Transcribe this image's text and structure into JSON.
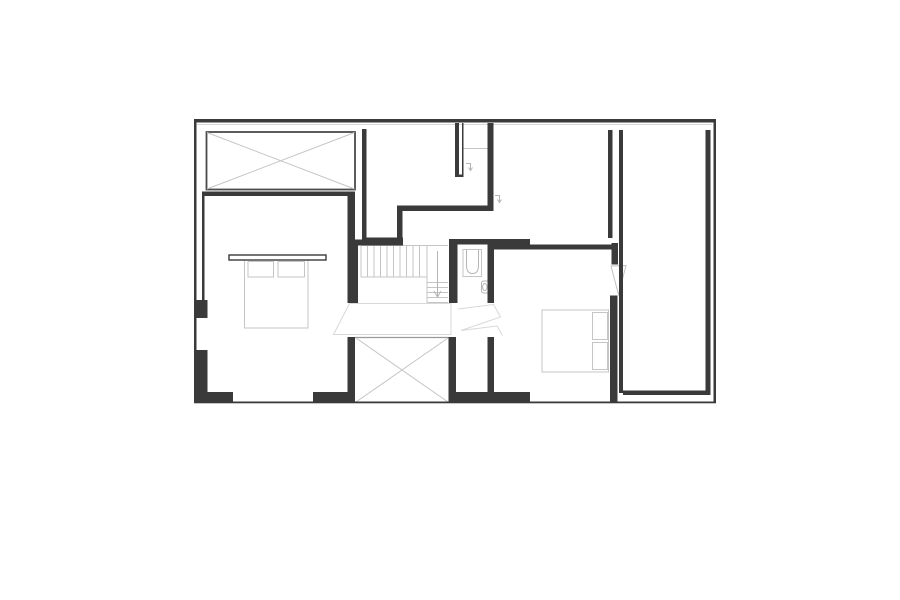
{
  "canvas": {
    "width": 900,
    "height": 600,
    "background": "#ffffff"
  },
  "palette": {
    "wall_color": "#3a3a3a",
    "outline_color": "#4a4a4a",
    "light_gray": "#c5c5c5",
    "mid_gray": "#9a9a9a",
    "fixture_gray": "#b5b5b5",
    "shadow_gray": "#d8d8d8"
  },
  "plan": {
    "styles": {
      "wall": {
        "fill": "#3a3a3a",
        "stroke": "none",
        "sw": 0
      },
      "outline": {
        "fill": "none",
        "stroke": "#4a4a4a",
        "sw": 1.8
      },
      "light": {
        "fill": "none",
        "stroke": "#c5c5c5",
        "sw": 1
      },
      "lighter": {
        "fill": "none",
        "stroke": "#d8d8d8",
        "sw": 1
      },
      "mid": {
        "fill": "none",
        "stroke": "#9a9a9a",
        "sw": 1.2
      },
      "fixture": {
        "fill": "none",
        "stroke": "#b5b5b5",
        "sw": 1
      },
      "headboard": {
        "fill": "#ffffff",
        "stroke": "#3a3a3a",
        "sw": 1.4
      },
      "leaf": {
        "fill": "#ffffff",
        "stroke": "#c0c0c0",
        "sw": 1
      }
    },
    "shapes": [
      {
        "name": "top-wall-shadow-line",
        "kind": "line",
        "x1": 197,
        "y1": 124.5,
        "x2": 712,
        "y2": 124.5,
        "style": "lighter"
      },
      {
        "name": "skylight-box-outline",
        "kind": "rect",
        "x": 206.5,
        "y": 132,
        "w": 148.5,
        "h": 57.5,
        "style": "outline"
      },
      {
        "name": "skylight-box-diagonal",
        "kind": "line",
        "x1": 207,
        "y1": 132.5,
        "x2": 354.5,
        "y2": 189,
        "style": "light"
      },
      {
        "name": "skylight-box-diagonal",
        "kind": "line",
        "x1": 354.5,
        "y1": 132.5,
        "x2": 207,
        "y2": 189,
        "style": "light"
      },
      {
        "name": "void-box-top-edge",
        "kind": "line",
        "x1": 355,
        "y1": 337.5,
        "x2": 448.5,
        "y2": 337.5,
        "style": "mid"
      },
      {
        "name": "void-box-diagonal",
        "kind": "line",
        "x1": 356,
        "y1": 338,
        "x2": 448,
        "y2": 402,
        "style": "light"
      },
      {
        "name": "void-box-diagonal",
        "kind": "line",
        "x1": 448,
        "y1": 338,
        "x2": 356,
        "y2": 402,
        "style": "light"
      },
      {
        "name": "stair-tread",
        "kind": "line",
        "x1": 361,
        "y1": 246,
        "x2": 361,
        "y2": 277,
        "style": "light"
      },
      {
        "name": "stair-tread",
        "kind": "line",
        "x1": 367.5,
        "y1": 246,
        "x2": 367.5,
        "y2": 277,
        "style": "light"
      },
      {
        "name": "stair-tread",
        "kind": "line",
        "x1": 374,
        "y1": 246,
        "x2": 374,
        "y2": 277,
        "style": "light"
      },
      {
        "name": "stair-tread",
        "kind": "line",
        "x1": 380.5,
        "y1": 246,
        "x2": 380.5,
        "y2": 277,
        "style": "light"
      },
      {
        "name": "stair-tread",
        "kind": "line",
        "x1": 387,
        "y1": 246,
        "x2": 387,
        "y2": 277,
        "style": "light"
      },
      {
        "name": "stair-tread",
        "kind": "line",
        "x1": 393.5,
        "y1": 246,
        "x2": 393.5,
        "y2": 277,
        "style": "light"
      },
      {
        "name": "stair-tread",
        "kind": "line",
        "x1": 400,
        "y1": 246,
        "x2": 400,
        "y2": 277,
        "style": "light"
      },
      {
        "name": "stair-tread",
        "kind": "line",
        "x1": 406.5,
        "y1": 246,
        "x2": 406.5,
        "y2": 277,
        "style": "light"
      },
      {
        "name": "stair-tread",
        "kind": "line",
        "x1": 413,
        "y1": 246,
        "x2": 413,
        "y2": 277,
        "style": "light"
      },
      {
        "name": "stair-tread",
        "kind": "line",
        "x1": 419.5,
        "y1": 246,
        "x2": 419.5,
        "y2": 277,
        "style": "light"
      },
      {
        "name": "stair-top-edge",
        "kind": "line",
        "x1": 361,
        "y1": 245.5,
        "x2": 448,
        "y2": 245.5,
        "style": "light"
      },
      {
        "name": "stair-flight-edge",
        "kind": "line",
        "x1": 427,
        "y1": 245.5,
        "x2": 427,
        "y2": 302.5,
        "style": "light"
      },
      {
        "name": "stair-landing-edge",
        "kind": "line",
        "x1": 361,
        "y1": 277,
        "x2": 427,
        "y2": 277,
        "style": "light"
      },
      {
        "name": "stair-tread",
        "kind": "line",
        "x1": 427,
        "y1": 282.5,
        "x2": 448,
        "y2": 282.5,
        "style": "light"
      },
      {
        "name": "stair-tread",
        "kind": "line",
        "x1": 427,
        "y1": 287.5,
        "x2": 448,
        "y2": 287.5,
        "style": "light"
      },
      {
        "name": "stair-tread",
        "kind": "line",
        "x1": 427,
        "y1": 292.5,
        "x2": 448,
        "y2": 292.5,
        "style": "light"
      },
      {
        "name": "stair-tread",
        "kind": "line",
        "x1": 427,
        "y1": 297.5,
        "x2": 448,
        "y2": 297.5,
        "style": "light"
      },
      {
        "name": "stair-bottom-edge",
        "kind": "line",
        "x1": 427,
        "y1": 302.5,
        "x2": 448,
        "y2": 302.5,
        "style": "light"
      },
      {
        "name": "stair-direction-arrow-stem",
        "kind": "line",
        "x1": 437.5,
        "y1": 251,
        "x2": 437.5,
        "y2": 296,
        "style": "fixture"
      },
      {
        "name": "stair-direction-arrow-head",
        "kind": "polyline",
        "points": "434,291 437.5,297 441,291",
        "style": "fixture"
      },
      {
        "name": "fan-sightline-left",
        "kind": "polygon",
        "points": "349.5,303.5 451,303.5 451,334.5 333.5,334.5",
        "style": "lighter"
      },
      {
        "name": "fan-sightline-right",
        "kind": "polyline",
        "points": "458,309 493.5,304.5 500.5,317 461,330.5 497,326 502.5,335.5",
        "style": "lighter"
      },
      {
        "name": "bed-left-body",
        "kind": "rect",
        "x": 244.5,
        "y": 260,
        "w": 63.5,
        "h": 68,
        "style": "light"
      },
      {
        "name": "bed-left-pillow",
        "kind": "rect",
        "x": 248,
        "y": 261.5,
        "w": 25.5,
        "h": 15.5,
        "style": "light"
      },
      {
        "name": "bed-left-pillow",
        "kind": "rect",
        "x": 278,
        "y": 261.5,
        "w": 26.5,
        "h": 15.5,
        "style": "light"
      },
      {
        "name": "bed-left-headboard-shelf",
        "kind": "rect",
        "x": 229,
        "y": 255,
        "w": 97,
        "h": 5,
        "style": "headboard"
      },
      {
        "name": "bed-right-body",
        "kind": "rect",
        "x": 542,
        "y": 310,
        "w": 66.5,
        "h": 62,
        "style": "light"
      },
      {
        "name": "bed-right-pillow",
        "kind": "rect",
        "x": 592.5,
        "y": 312.5,
        "w": 15,
        "h": 27,
        "style": "light"
      },
      {
        "name": "bed-right-pillow",
        "kind": "rect",
        "x": 592.5,
        "y": 342.5,
        "w": 15,
        "h": 27,
        "style": "light"
      },
      {
        "name": "shower-outline",
        "kind": "rect",
        "x": 463,
        "y": 249.5,
        "w": 18.5,
        "h": 27,
        "style": "light"
      },
      {
        "name": "shower-basin",
        "kind": "path",
        "d": "M466.5,250 L466.5,265.5 Q466.5,273.5 472.5,273.5 Q478.5,273.5 478.5,265.5 L478.5,250",
        "style": "fixture"
      },
      {
        "name": "toilet-outline",
        "kind": "rect",
        "x": 481.5,
        "y": 281,
        "w": 7,
        "h": 12,
        "rx": 2,
        "style": "fixture"
      },
      {
        "name": "toilet-bowl",
        "kind": "ellipse",
        "cx": 484.8,
        "cy": 287,
        "rx": 2.2,
        "ry": 3.6,
        "style": "fixture"
      },
      {
        "name": "nook-shelf-line",
        "kind": "line",
        "x1": 463.5,
        "y1": 148.5,
        "x2": 487.5,
        "y2": 148.5,
        "style": "light"
      },
      {
        "name": "door-swing-symbol",
        "kind": "polyline",
        "points": "466,163.5 470.5,163.5 470.5,169.5",
        "style": "fixture"
      },
      {
        "name": "door-swing-symbol-arrow",
        "kind": "polyline",
        "points": "468.5,167.5 470.5,170.5 472.5,167.5",
        "style": "fixture"
      },
      {
        "name": "door-swing-symbol",
        "kind": "polyline",
        "points": "495,195.5 499.5,195.5 499.5,201.5",
        "style": "fixture"
      },
      {
        "name": "door-swing-symbol-arrow",
        "kind": "polyline",
        "points": "497.5,199.5 499.5,202.5 501.5,199.5",
        "style": "fixture"
      },
      {
        "name": "door-leaf-right-bedroom",
        "kind": "polygon",
        "points": "611,266 626,265.5 618.5,294.5",
        "style": "leaf"
      },
      {
        "name": "outer-wall-top",
        "kind": "rect",
        "x": 194,
        "y": 119,
        "w": 522,
        "h": 3.5,
        "style": "wall"
      },
      {
        "name": "outer-wall-left",
        "kind": "rect",
        "x": 194,
        "y": 119,
        "w": 2.5,
        "h": 284,
        "style": "wall"
      },
      {
        "name": "outer-wall-right",
        "kind": "rect",
        "x": 713.5,
        "y": 119,
        "w": 2.5,
        "h": 284,
        "style": "wall"
      },
      {
        "name": "outer-wall-bottom",
        "kind": "rect",
        "x": 194,
        "y": 401.5,
        "w": 522,
        "h": 1.8,
        "style": "wall"
      },
      {
        "name": "bedroom-left-top-wall",
        "kind": "rect",
        "x": 202,
        "y": 191.5,
        "w": 149,
        "h": 4.5,
        "style": "wall"
      },
      {
        "name": "bedroom-left-west-partition",
        "kind": "rect",
        "x": 202,
        "y": 191.5,
        "w": 2.5,
        "h": 126.5,
        "style": "wall"
      },
      {
        "name": "west-wall-stub",
        "kind": "rect",
        "x": 196.5,
        "y": 300,
        "w": 11,
        "h": 18,
        "style": "wall"
      },
      {
        "name": "west-corner-wall-vertical",
        "kind": "rect",
        "x": 196.5,
        "y": 350,
        "w": 11,
        "h": 53,
        "style": "wall"
      },
      {
        "name": "west-corner-wall-horizontal",
        "kind": "rect",
        "x": 196.5,
        "y": 392,
        "w": 36.5,
        "h": 11,
        "style": "wall"
      },
      {
        "name": "bedroom-left-east-wall",
        "kind": "rect",
        "x": 347.5,
        "y": 191.5,
        "w": 7.5,
        "h": 111.5,
        "style": "wall"
      },
      {
        "name": "room-top-mid-west-wall",
        "kind": "rect",
        "x": 362,
        "y": 129,
        "w": 4.5,
        "h": 113,
        "style": "wall"
      },
      {
        "name": "room-top-mid-bottom-wall",
        "kind": "rect",
        "x": 362,
        "y": 237.5,
        "w": 41,
        "h": 4.5,
        "style": "wall"
      },
      {
        "name": "stair-top-wall",
        "kind": "rect",
        "x": 352,
        "y": 239.5,
        "w": 51,
        "h": 6,
        "style": "wall"
      },
      {
        "name": "step-vertical-wall",
        "kind": "rect",
        "x": 397,
        "y": 205.5,
        "w": 5.5,
        "h": 36.5,
        "style": "wall"
      },
      {
        "name": "step-horizontal-wall",
        "kind": "rect",
        "x": 397,
        "y": 205.5,
        "w": 96,
        "h": 5.5,
        "style": "wall"
      },
      {
        "name": "mid-divider-wall",
        "kind": "rect",
        "x": 487.5,
        "y": 123,
        "w": 6,
        "h": 88,
        "style": "wall"
      },
      {
        "name": "duct-wall-thick",
        "kind": "rect",
        "x": 455,
        "y": 123,
        "w": 4,
        "h": 54,
        "style": "wall"
      },
      {
        "name": "duct-wall-thin",
        "kind": "rect",
        "x": 462,
        "y": 123,
        "w": 1.5,
        "h": 52,
        "style": "wall"
      },
      {
        "name": "duct-bottom-cap",
        "kind": "rect",
        "x": 455,
        "y": 174.5,
        "w": 8.5,
        "h": 2.5,
        "style": "wall"
      },
      {
        "name": "bathroom-top-wall",
        "kind": "rect",
        "x": 449,
        "y": 239,
        "w": 81,
        "h": 5.5,
        "style": "wall"
      },
      {
        "name": "bedroom-right-top-wall",
        "kind": "rect",
        "x": 490,
        "y": 244.5,
        "w": 123,
        "h": 5,
        "style": "wall"
      },
      {
        "name": "stair-west-wall",
        "kind": "rect",
        "x": 352,
        "y": 245,
        "w": 6,
        "h": 58,
        "style": "wall"
      },
      {
        "name": "bathroom-west-wall",
        "kind": "rect",
        "x": 449,
        "y": 244.5,
        "w": 8.5,
        "h": 58.5,
        "style": "wall"
      },
      {
        "name": "bathroom-east-wall",
        "kind": "rect",
        "x": 487.5,
        "y": 244.5,
        "w": 6.5,
        "h": 58.5,
        "style": "wall"
      },
      {
        "name": "void-west-wall",
        "kind": "rect",
        "x": 347.5,
        "y": 337,
        "w": 7.5,
        "h": 66,
        "style": "wall"
      },
      {
        "name": "void-east-wall",
        "kind": "rect",
        "x": 448.5,
        "y": 337,
        "w": 7.5,
        "h": 66,
        "style": "wall"
      },
      {
        "name": "bottom-wall-mid-left",
        "kind": "rect",
        "x": 313,
        "y": 392,
        "w": 42,
        "h": 11,
        "style": "wall"
      },
      {
        "name": "closet-east-wall",
        "kind": "rect",
        "x": 487.5,
        "y": 337,
        "w": 6.5,
        "h": 60,
        "style": "wall"
      },
      {
        "name": "bottom-wall-bath",
        "kind": "rect",
        "x": 449,
        "y": 392,
        "w": 81,
        "h": 11,
        "style": "wall"
      },
      {
        "name": "bedroom-right-east-wall-stub",
        "kind": "rect",
        "x": 611.5,
        "y": 243,
        "w": 6.5,
        "h": 21.5,
        "style": "wall"
      },
      {
        "name": "bedroom-right-east-wall",
        "kind": "rect",
        "x": 610,
        "y": 295.5,
        "w": 7.5,
        "h": 107.5,
        "style": "wall"
      },
      {
        "name": "shaft-west-wall",
        "kind": "rect",
        "x": 608,
        "y": 130,
        "w": 4.5,
        "h": 108,
        "style": "wall"
      },
      {
        "name": "rightroom-west-wall",
        "kind": "rect",
        "x": 619,
        "y": 130,
        "w": 4,
        "h": 263,
        "style": "wall"
      },
      {
        "name": "rightroom-bottom-wall",
        "kind": "rect",
        "x": 623,
        "y": 390.5,
        "w": 87.5,
        "h": 4.5,
        "style": "wall"
      },
      {
        "name": "rightroom-east-wall",
        "kind": "rect",
        "x": 705.5,
        "y": 130,
        "w": 5,
        "h": 265,
        "style": "wall"
      }
    ]
  }
}
